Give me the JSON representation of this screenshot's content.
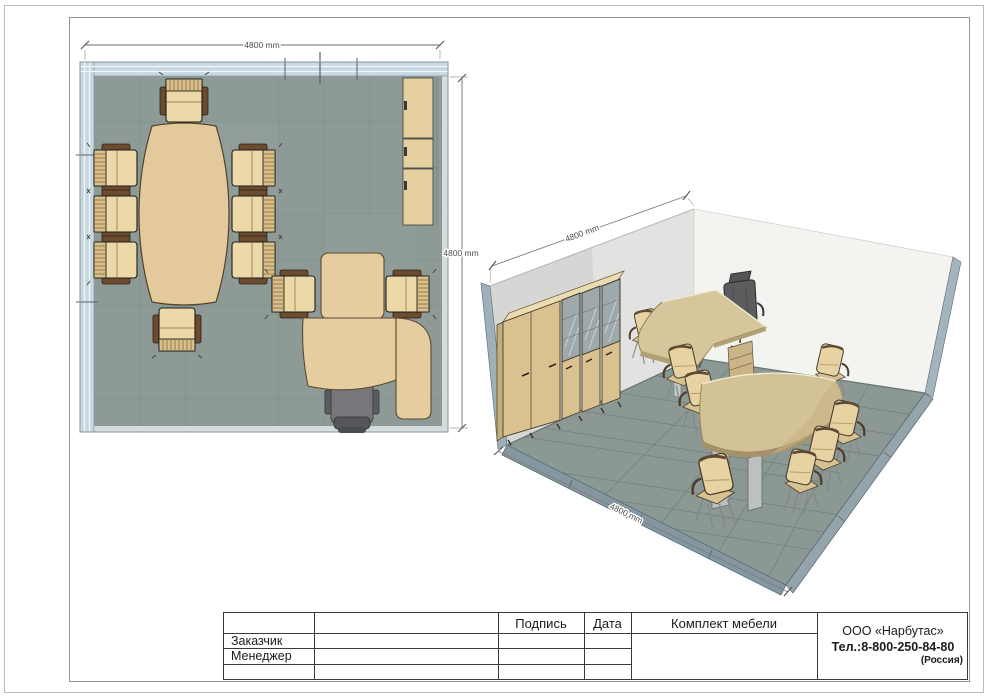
{
  "plan_view": {
    "dim_width_label": "4800 mm",
    "dim_depth_label": "4800 mm"
  },
  "iso_view": {
    "dim_wall_label": "4800 mm",
    "dim_floor_label": "4800 mm"
  },
  "title_block": {
    "signature_header": "Подпись",
    "date_header": "Дата",
    "furniture_set_header": "Комплект мебели",
    "customer_label": "Заказчик",
    "manager_label": "Менеджер",
    "company": {
      "name": "ООО «Нарбутас»",
      "phone": "Тел.:8-800-250-84-80",
      "country": "(Россия)"
    }
  },
  "room": {
    "width_mm": 4800,
    "depth_mm": 4800,
    "furniture": {
      "conference_table": 1,
      "conference_chairs": 8,
      "visitor_chairs": 2,
      "executive_desk_with_extension": 1,
      "executive_chair": 1,
      "wardrobe": 1,
      "glass_bookcases": 2
    }
  },
  "colors": {
    "floor": "#8b9894",
    "window_wall": "#c7d8e2",
    "wood": "#e2c89b",
    "trim": "#9eb0b8",
    "chair_tan": "#e8d4a4",
    "exec_chair": "#5b5c5e",
    "back_wall": "#f3f3f0",
    "side_wall": "#dcdcda"
  }
}
